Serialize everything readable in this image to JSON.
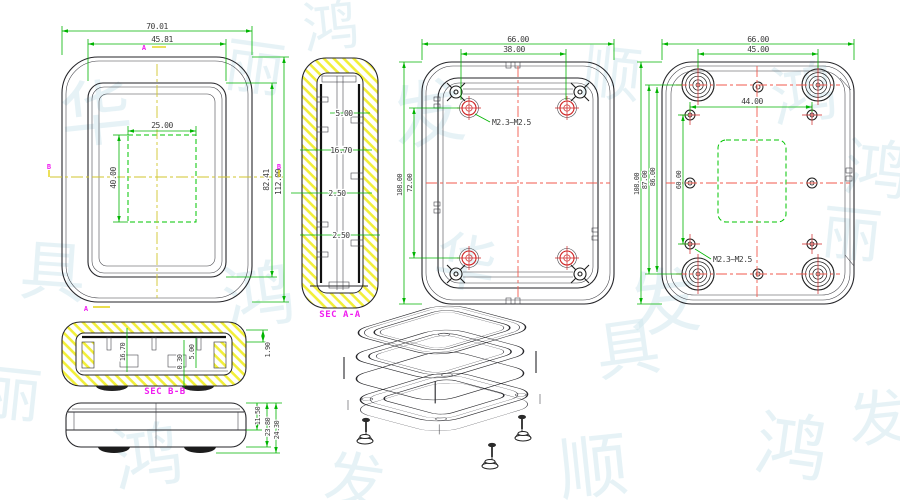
{
  "front": {
    "width_outer": "70.01",
    "width_bezel": "45.81",
    "cutout_width": "25.00",
    "cutout_height": "40.00",
    "height_bezel": "82.41",
    "height_outer": "112.00",
    "marker_a": "A",
    "marker_b": "B"
  },
  "section_aa": {
    "label": "SEC A-A",
    "dim_top": "5.00",
    "dim_mid": "16.70",
    "dim_wall1": "2.50",
    "dim_wall2": "2.50"
  },
  "back_inner": {
    "width_outer": "66.00",
    "boss_span_x": "38.00",
    "height_outer": "108.00",
    "boss_span_y": "72.00",
    "thread": "M2.3~M2.5"
  },
  "back_outer": {
    "width_outer": "66.00",
    "feet_span_x": "45.00",
    "hole_span_x": "44.00",
    "height_outer": "108.00",
    "feet_span_y": "87.00",
    "center_span_y": "86.00",
    "hole_span_y": "60.00",
    "thread": "M2.3~M2.5"
  },
  "section_bb": {
    "label": "SEC B-B",
    "depth_inner": "16.70",
    "gap": "0.30",
    "boss_height": "5.00",
    "lip": "1.90"
  },
  "side": {
    "height_top": "11.50",
    "height_body": "23.80",
    "height_total": "24.30"
  },
  "watermark": {
    "glyphs": [
      "华",
      "丽",
      "发",
      "顺",
      "鸿",
      "具",
      "鸿",
      "华",
      "发",
      "丽",
      "鸿",
      "发",
      "顺",
      "鸿",
      "具",
      "鸿",
      "发",
      "丽",
      "鸿"
    ]
  }
}
